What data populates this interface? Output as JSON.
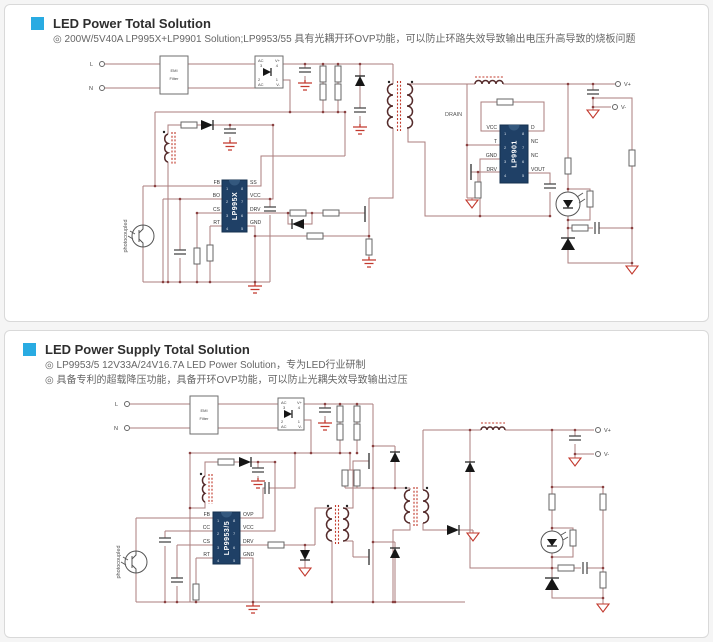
{
  "colors": {
    "accent": "#29abe2",
    "wire": "#ab7d7d",
    "chip": "#1f4066",
    "ground": "#c2392e"
  },
  "panels": [
    {
      "title": "LED Power Total Solution",
      "bullets": [
        "◎ 200W/5V40A LP995X+LP9901 Solution;LP9953/55 具有光耦开环OVP功能，可以防止环路失效导致输出电压升高导致的烧板问题"
      ],
      "sch": {
        "in": [
          "L",
          "N"
        ],
        "emi": [
          "EMI",
          "Filter"
        ],
        "bridge": {
          "tl": [
            "AC",
            "3"
          ],
          "tr": [
            "V+",
            "4"
          ],
          "bl": [
            "2",
            "AC"
          ],
          "br": [
            "1",
            "V-"
          ]
        },
        "out": [
          "V+",
          "V-"
        ],
        "drain": "DRAIN",
        "opto": "photocoupled",
        "ic1": {
          "name": "LP995X",
          "lp": [
            "FB",
            "BO",
            "CS",
            "RT"
          ],
          "rp": [
            "SS",
            "VCC",
            "DRV",
            "GND"
          ],
          "ln": [
            "1",
            "2",
            "3",
            "4"
          ],
          "rn": [
            "8",
            "7",
            "6",
            "5"
          ]
        },
        "ic2": {
          "name": "LP9901",
          "lp": [
            "VCC",
            "T",
            "GND",
            "DRV"
          ],
          "rp": [
            "D",
            "NC",
            "NC",
            "VOUT"
          ],
          "ln": [
            "1",
            "2",
            "3",
            "4"
          ],
          "rn": [
            "8",
            "7",
            "6",
            "5"
          ]
        }
      }
    },
    {
      "title": "LED Power Supply Total Solution",
      "bullets": [
        "◎ LP9953/5 12V33A/24V16.7A LED Power Solution，专为LED行业研制",
        "◎ 具备专利的超载降压功能，具备开环OVP功能，可以防止光耦失效导致输出过压"
      ],
      "sch": {
        "in": [
          "L",
          "N"
        ],
        "emi": [
          "EMI",
          "Filter"
        ],
        "bridge": {
          "tl": [
            "AC",
            "3"
          ],
          "tr": [
            "V+",
            "4"
          ],
          "bl": [
            "2",
            "AC"
          ],
          "br": [
            "1",
            "V-"
          ]
        },
        "out": [
          "V+",
          "V-"
        ],
        "opto": "photocoupled",
        "ic1": {
          "name": "LP9953/5",
          "lp": [
            "FB",
            "CC",
            "CS",
            "RT"
          ],
          "rp": [
            "OVP",
            "VCC",
            "DRV",
            "GND"
          ],
          "ln": [
            "1",
            "2",
            "3",
            "4"
          ],
          "rn": [
            "8",
            "7",
            "6",
            "5"
          ]
        }
      }
    }
  ]
}
